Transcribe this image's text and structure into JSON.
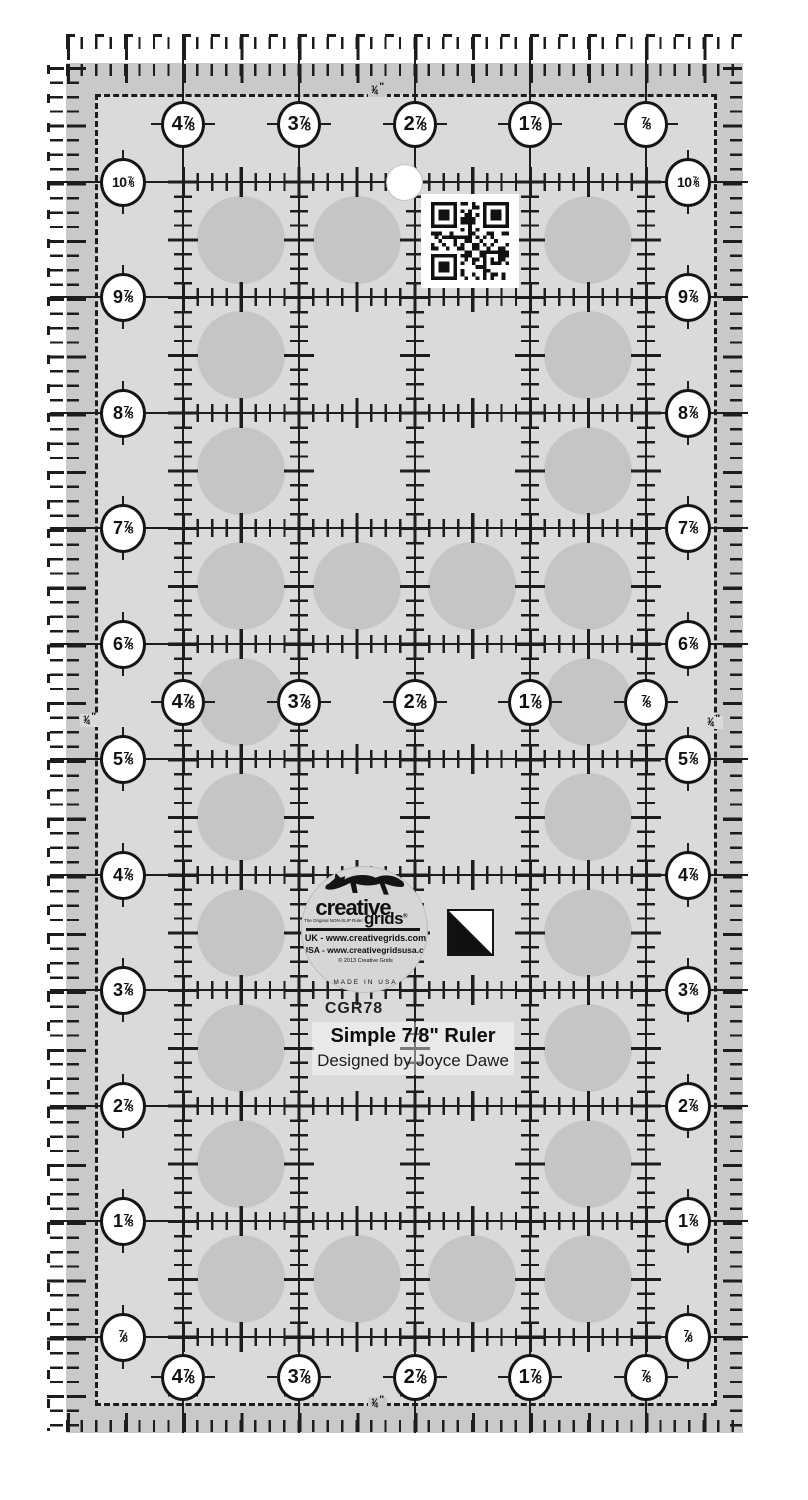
{
  "product": {
    "sku": "CGR78",
    "title": "Simple 7/8\" Ruler",
    "designer": "Designed by Joyce Dawe"
  },
  "logo": {
    "brand_top": "creative",
    "brand_bottom": "grids",
    "registered": "®",
    "tagline": "The Original NON-SLIP Ruler",
    "line_uk": "UK - www.creativegrids.com",
    "line_usa": "USA - www.creativegridsusa.com",
    "copyright": "© 2013 Creative Grids",
    "made_in": "MADE IN USA"
  },
  "ruler": {
    "quarter_label": "1/4\"",
    "edge_labels": {
      "top": [
        "4 7/8",
        "3 7/8",
        "2 7/8",
        "1 7/8",
        "7/8"
      ],
      "middle": [
        "4 7/8",
        "3 7/8",
        "2 7/8",
        "1 7/8",
        "7/8"
      ],
      "bottom": [
        "4 7/8",
        "3 7/8",
        "2 7/8",
        "1 7/8",
        "7/8"
      ],
      "left": [
        "10 7/8",
        "9 7/8",
        "8 7/8",
        "7 7/8",
        "6 7/8",
        "5 7/8",
        "4 7/8",
        "3 7/8",
        "2 7/8",
        "1 7/8",
        "7/8"
      ],
      "right": [
        "10 7/8",
        "9 7/8",
        "8 7/8",
        "7 7/8",
        "6 7/8",
        "5 7/8",
        "4 7/8",
        "3 7/8",
        "2 7/8",
        "1 7/8",
        "7/8"
      ]
    }
  },
  "colors": {
    "ink": "#1d1d1d",
    "band": "#c9c9c9",
    "surface": "#dadada",
    "dot": "#c5c5c5",
    "badge_bg": "#ffffff",
    "background": "#ffffff"
  },
  "geometry": {
    "slab": {
      "x": 66,
      "y": 63,
      "w": 677,
      "h": 1370
    },
    "dashed": {
      "x": 95,
      "y": 94,
      "w": 622,
      "h": 1312
    },
    "verticals": [
      183,
      299,
      415,
      530,
      646
    ],
    "horizontals": [
      182,
      297,
      413,
      528,
      644,
      759,
      875,
      990,
      1106,
      1221,
      1337
    ],
    "badge_rows": {
      "top": 124,
      "middle": 702,
      "bottom": 1377
    },
    "badge_cols": {
      "left": 123,
      "right": 688
    },
    "cell_cols": [
      241,
      357,
      472,
      588
    ],
    "cell_rows": [
      240,
      355,
      471,
      586,
      702,
      817,
      933,
      1048,
      1164,
      1279
    ],
    "dot_diameter": 88,
    "grip_dots": [
      [
        1,
        1
      ],
      [
        2,
        1
      ],
      [
        4,
        1
      ],
      [
        1,
        2
      ],
      [
        4,
        2
      ],
      [
        1,
        3
      ],
      [
        4,
        3
      ],
      [
        1,
        4
      ],
      [
        2,
        4
      ],
      [
        3,
        4
      ],
      [
        4,
        4
      ],
      [
        1,
        5
      ],
      [
        4,
        5
      ],
      [
        1,
        6
      ],
      [
        4,
        6
      ],
      [
        1,
        7
      ],
      [
        4,
        7
      ],
      [
        1,
        8
      ],
      [
        4,
        8
      ],
      [
        1,
        9
      ],
      [
        4,
        9
      ],
      [
        1,
        10
      ],
      [
        2,
        10
      ],
      [
        3,
        10
      ],
      [
        4,
        10
      ]
    ],
    "quarters": [
      {
        "x": 381,
        "y": 93,
        "bg": "band"
      },
      {
        "x": 93,
        "y": 723,
        "bg": "surface"
      },
      {
        "x": 717,
        "y": 725,
        "bg": "surface"
      },
      {
        "x": 381,
        "y": 1406,
        "bg": "band"
      }
    ]
  }
}
